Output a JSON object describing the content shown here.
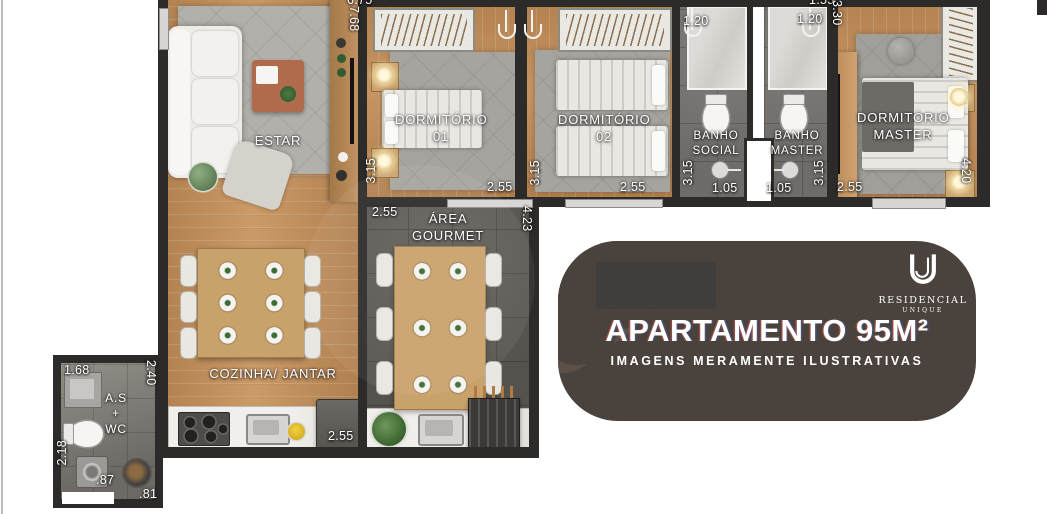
{
  "plan": {
    "rooms": {
      "estar": "ESTAR",
      "dormitorio_01": {
        "l1": "DORMITÓRIO",
        "l2": "01"
      },
      "dormitorio_02": {
        "l1": "DORMITÓRIO",
        "l2": "02"
      },
      "banho_social": {
        "l1": "BANHO",
        "l2": "SOCIAL"
      },
      "banho_master": {
        "l1": "BANHO",
        "l2": "MASTER"
      },
      "dormitorio_master": {
        "l1": "DORMITÓRIO",
        "l2": "MASTER"
      },
      "area_gourmet": {
        "l1": "ÁREA",
        "l2": "GOURMET"
      },
      "cozinha_jantar": "COZINHA/ JANTAR",
      "as_wc": {
        "l1": "A.S",
        "l2": "+",
        "l3": "WC"
      }
    },
    "measurements": {
      "top_width": "6.75",
      "estar_depth": "7.68",
      "dorm1_height": "3.15",
      "dorm1_width": "2.55",
      "dorm2_height": "3.15",
      "dorm2_width": "2.55",
      "banho_social_door": "1.20",
      "banho_social_height": "3.15",
      "banho_social_width": "1.05",
      "banho_master_door": "1.20",
      "banho_master_width": "1.05",
      "banho_master_height": "3.15",
      "master_top": "1.55",
      "master_side": "3.30",
      "master_width": "2.55",
      "master_height": "4.20",
      "gourmet_top": "2.55",
      "gourmet_width": "2.55",
      "gourmet_height": "4.23",
      "kitchen_width": "2.55",
      "aswc_top": "1.68",
      "aswc_right": "2.40",
      "aswc_left": "2.18",
      "aswc_w1": ".87",
      "aswc_w2": ".81"
    }
  },
  "badge": {
    "title": "APARTAMENTO 95M²",
    "subtitle": "IMAGENS MERAMENTE ILUSTRATIVAS",
    "logo_brand": "RESIDENCIAL",
    "logo_sub": "UNIQUE"
  },
  "colors": {
    "wall": "#2d2b29",
    "wood": "#c3905d",
    "badge_bg": "#4a423c",
    "marble": "#efede9"
  }
}
